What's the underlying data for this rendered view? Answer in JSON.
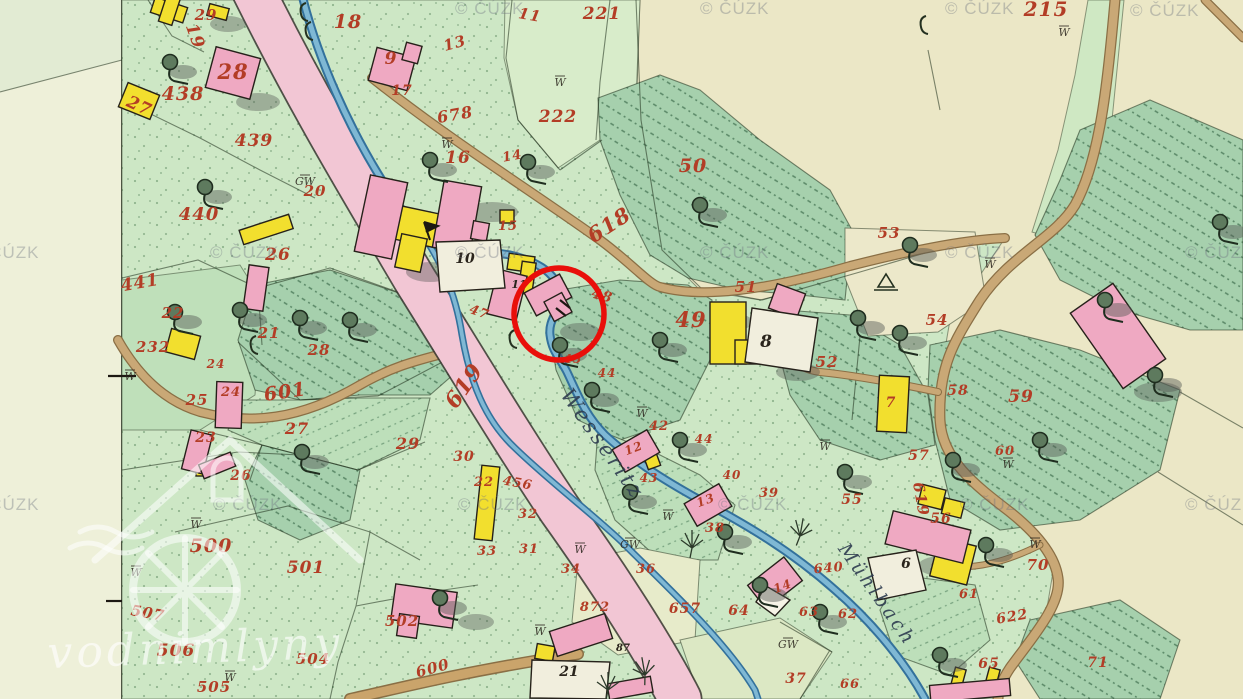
{
  "palette": {
    "paper": "#ebe7c6",
    "map_margin": "#eef0d9",
    "meadow_green": "#cde7c5",
    "forest_green": "#a6d0ad",
    "road_pink": "#f2c6d4",
    "path_tan": "#c9a876",
    "stream_blue": "#7fb8d4",
    "building_wood_yellow": "#f2df2e",
    "building_masonry_pink": "#efa9c2",
    "parcel_number_red": "#b33d26",
    "annotation_red": "#e90f0a"
  },
  "attribution": {
    "text": "© ČÚZK",
    "positions": [
      [
        455,
        14
      ],
      [
        700,
        14
      ],
      [
        945,
        14
      ],
      [
        1130,
        16
      ],
      [
        -30,
        258
      ],
      [
        210,
        258
      ],
      [
        455,
        258
      ],
      [
        700,
        258
      ],
      [
        945,
        258
      ],
      [
        1185,
        258
      ],
      [
        -30,
        510
      ],
      [
        213,
        510
      ],
      [
        458,
        510
      ],
      [
        718,
        510
      ],
      [
        960,
        510
      ],
      [
        1185,
        510
      ]
    ]
  },
  "logo_watermark": {
    "text": "vodnimlyny"
  },
  "stream_labels": [
    {
      "text": "Wesseritz",
      "x": 597,
      "y": 448,
      "rot": 55,
      "size": 21
    },
    {
      "text": "Mühlbach",
      "x": 872,
      "y": 598,
      "rot": 55,
      "size": 19
    }
  ],
  "parcel_numbers_red": [
    [
      "29",
      206,
      20,
      15,
      0
    ],
    [
      "19",
      190,
      38,
      17,
      70
    ],
    [
      "28",
      233,
      79,
      21,
      0
    ],
    [
      "438",
      183,
      100,
      19,
      0
    ],
    [
      "27",
      137,
      111,
      17,
      25
    ],
    [
      "18",
      348,
      28,
      19,
      0
    ],
    [
      "9",
      391,
      64,
      17,
      0
    ],
    [
      "17",
      402,
      95,
      14,
      0
    ],
    [
      "11",
      529,
      20,
      15,
      10
    ],
    [
      "221",
      602,
      19,
      17,
      0
    ],
    [
      "13",
      456,
      48,
      15,
      -15
    ],
    [
      "222",
      558,
      122,
      17,
      0
    ],
    [
      "678",
      456,
      120,
      16,
      -10
    ],
    [
      "16",
      458,
      163,
      17,
      0
    ],
    [
      "14",
      513,
      160,
      13,
      -10
    ],
    [
      "50",
      693,
      172,
      19,
      0
    ],
    [
      "215",
      1046,
      16,
      20,
      0
    ],
    [
      "439",
      254,
      146,
      17,
      0
    ],
    [
      "20",
      315,
      196,
      15,
      0
    ],
    [
      "440",
      199,
      220,
      18,
      0
    ],
    [
      "441",
      141,
      288,
      17,
      -10
    ],
    [
      "26",
      278,
      260,
      17,
      0
    ],
    [
      "22",
      173,
      318,
      15,
      0
    ],
    [
      "232",
      153,
      352,
      15,
      0
    ],
    [
      "21",
      269,
      338,
      15,
      0
    ],
    [
      "28",
      319,
      355,
      15,
      0
    ],
    [
      "24",
      216,
      368,
      12,
      0
    ],
    [
      "24",
      231,
      396,
      13,
      0
    ],
    [
      "25",
      197,
      405,
      15,
      0
    ],
    [
      "601",
      286,
      398,
      19,
      -8
    ],
    [
      "23",
      206,
      442,
      14,
      0
    ],
    [
      "26",
      241,
      480,
      14,
      0
    ],
    [
      "27",
      297,
      434,
      16,
      0
    ],
    [
      "29",
      408,
      449,
      16,
      0
    ],
    [
      "30",
      464,
      461,
      14,
      0
    ],
    [
      "22",
      484,
      486,
      13,
      0
    ],
    [
      "456",
      517,
      487,
      13,
      10
    ],
    [
      "32",
      528,
      518,
      13,
      0
    ],
    [
      "33",
      487,
      555,
      13,
      0
    ],
    [
      "31",
      529,
      553,
      13,
      0
    ],
    [
      "34",
      571,
      573,
      13,
      0
    ],
    [
      "872",
      595,
      611,
      13,
      0
    ],
    [
      "500",
      211,
      552,
      19,
      0
    ],
    [
      "501",
      306,
      573,
      17,
      0
    ],
    [
      "507",
      147,
      618,
      15,
      10
    ],
    [
      "502",
      402,
      626,
      15,
      0
    ],
    [
      "506",
      176,
      656,
      17,
      0
    ],
    [
      "504",
      313,
      664,
      15,
      0
    ],
    [
      "505",
      214,
      692,
      15,
      0
    ],
    [
      "600",
      434,
      673,
      15,
      -15
    ],
    [
      "619",
      470,
      390,
      22,
      -55
    ],
    [
      "618",
      613,
      231,
      21,
      -33
    ],
    [
      "47",
      478,
      316,
      13,
      20
    ],
    [
      "48",
      601,
      300,
      14,
      15
    ],
    [
      "45",
      573,
      363,
      12,
      0
    ],
    [
      "44",
      607,
      377,
      12,
      0
    ],
    [
      "42",
      659,
      430,
      13,
      0
    ],
    [
      "44",
      704,
      443,
      12,
      0
    ],
    [
      "40",
      732,
      479,
      12,
      0
    ],
    [
      "39",
      769,
      497,
      13,
      0
    ],
    [
      "43",
      649,
      482,
      12,
      0
    ],
    [
      "12",
      635,
      452,
      12,
      -20
    ],
    [
      "13",
      707,
      504,
      12,
      -20
    ],
    [
      "38",
      715,
      532,
      13,
      0
    ],
    [
      "49",
      691,
      327,
      21,
      0
    ],
    [
      "51",
      746,
      292,
      15,
      0
    ],
    [
      "52",
      827,
      367,
      15,
      0
    ],
    [
      "53",
      889,
      238,
      15,
      0
    ],
    [
      "54",
      937,
      325,
      15,
      0
    ],
    [
      "58",
      958,
      395,
      14,
      0
    ],
    [
      "59",
      1021,
      402,
      17,
      0
    ],
    [
      "57",
      919,
      460,
      14,
      0
    ],
    [
      "60",
      1005,
      455,
      13,
      0
    ],
    [
      "619",
      916,
      500,
      15,
      80
    ],
    [
      "56",
      941,
      523,
      14,
      0
    ],
    [
      "55",
      852,
      504,
      14,
      0
    ],
    [
      "7",
      891,
      407,
      14,
      0
    ],
    [
      "70",
      1038,
      570,
      15,
      0
    ],
    [
      "622",
      1013,
      621,
      14,
      -10
    ],
    [
      "61",
      969,
      598,
      13,
      0
    ],
    [
      "65",
      989,
      668,
      14,
      0
    ],
    [
      "71",
      1098,
      667,
      14,
      0
    ],
    [
      "66",
      850,
      688,
      13,
      0
    ],
    [
      "640",
      829,
      572,
      13,
      -5
    ],
    [
      "657",
      685,
      613,
      14,
      0
    ],
    [
      "64",
      739,
      615,
      14,
      0
    ],
    [
      "63",
      809,
      616,
      13,
      0
    ],
    [
      "62",
      848,
      618,
      13,
      0
    ],
    [
      "14",
      784,
      590,
      12,
      -20
    ],
    [
      "37",
      796,
      683,
      14,
      0
    ],
    [
      "36",
      646,
      573,
      13,
      0
    ],
    [
      "15",
      508,
      230,
      13,
      0
    ]
  ],
  "house_numbers_black": [
    [
      "10",
      465,
      263,
      14
    ],
    [
      "11",
      519,
      288,
      11
    ],
    [
      "8",
      766,
      347,
      17
    ],
    [
      "21",
      569,
      676,
      14
    ],
    [
      "6",
      906,
      568,
      14
    ],
    [
      "87",
      623,
      651,
      10
    ]
  ],
  "meadow_marks": [
    [
      "GW",
      305,
      185
    ],
    [
      "GW",
      630,
      548
    ],
    [
      "GW",
      788,
      648
    ],
    [
      "W",
      447,
      148
    ],
    [
      "W",
      560,
      86
    ],
    [
      "W",
      642,
      417
    ],
    [
      "W",
      1064,
      36
    ],
    [
      "W",
      1035,
      548
    ],
    [
      "W",
      1008,
      468
    ],
    [
      "W",
      196,
      528
    ],
    [
      "W",
      136,
      576
    ],
    [
      "W",
      990,
      268
    ],
    [
      "W",
      825,
      450
    ],
    [
      "W",
      580,
      553
    ],
    [
      "W",
      668,
      520
    ],
    [
      "W",
      230,
      681
    ],
    [
      "W",
      130,
      380
    ],
    [
      "W",
      540,
      635
    ]
  ],
  "map_symbols": {
    "trees": [
      [
        170,
        62
      ],
      [
        205,
        187
      ],
      [
        175,
        312
      ],
      [
        300,
        318
      ],
      [
        302,
        452
      ],
      [
        440,
        598
      ],
      [
        528,
        162
      ],
      [
        560,
        345
      ],
      [
        660,
        340
      ],
      [
        700,
        205
      ],
      [
        680,
        440
      ],
      [
        725,
        532
      ],
      [
        845,
        472
      ],
      [
        910,
        245
      ],
      [
        900,
        333
      ],
      [
        953,
        460
      ],
      [
        940,
        655
      ],
      [
        1040,
        440
      ],
      [
        1105,
        300
      ],
      [
        1220,
        222
      ],
      [
        760,
        585
      ],
      [
        820,
        612
      ],
      [
        592,
        390
      ],
      [
        630,
        492
      ],
      [
        858,
        318
      ],
      [
        986,
        545
      ],
      [
        1155,
        375
      ],
      [
        350,
        320
      ],
      [
        240,
        310
      ],
      [
        430,
        160
      ]
    ],
    "reeds": [
      [
        692,
        548,
        0
      ],
      [
        800,
        536,
        10
      ],
      [
        645,
        675,
        -10
      ],
      [
        608,
        690,
        0
      ]
    ],
    "hooks": [
      [
        303,
        14
      ],
      [
        308,
        33
      ],
      [
        923,
        27
      ],
      [
        253,
        347
      ],
      [
        512,
        341
      ]
    ],
    "survey_triangle": [
      886,
      283
    ],
    "flag": [
      424,
      222
    ],
    "edge_ticks": [
      [
        108,
        376,
        136,
        376
      ],
      [
        106,
        601,
        122,
        601
      ]
    ]
  },
  "annotation_circle": {
    "cx": 559,
    "cy": 314,
    "rx": 45,
    "ry": 46,
    "stroke": "#e90f0a",
    "width": 5.5
  }
}
